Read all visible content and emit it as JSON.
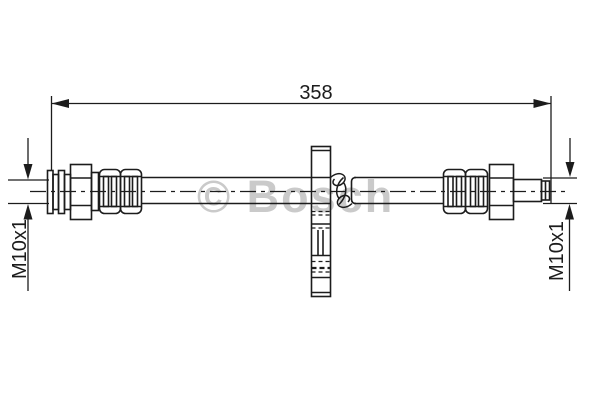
{
  "drawing": {
    "title": "brake-hose-technical-drawing",
    "watermark": {
      "label": "© Bosch"
    },
    "dimensions": {
      "length": {
        "label": "358"
      },
      "left_thread": {
        "label": "M10x1"
      },
      "right_thread": {
        "label": "M10x1"
      }
    },
    "colors": {
      "line": "#1c1c1c",
      "watermark": "#cacaca",
      "background": "#ffffff"
    }
  }
}
